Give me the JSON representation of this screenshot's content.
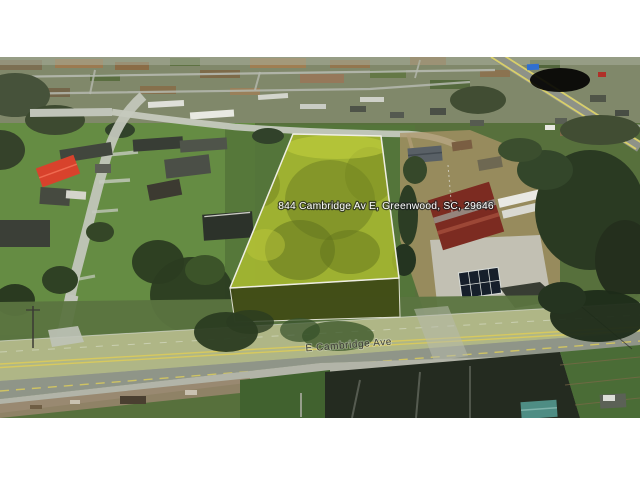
{
  "map_view": {
    "address_label": "844 Cambridge Av E, Greenwood, SC, 29646",
    "street_label": "E Cambridge Ave"
  },
  "colors": {
    "parcel_fill": "#a9ba30",
    "parcel_side": "#414b15",
    "parcel_outline": "#efeee3",
    "road_overlay": "#b3ba85",
    "address_text_color": "#ffffff",
    "street_text_color": "#3e3e38",
    "letterbox": "#ffffff"
  }
}
